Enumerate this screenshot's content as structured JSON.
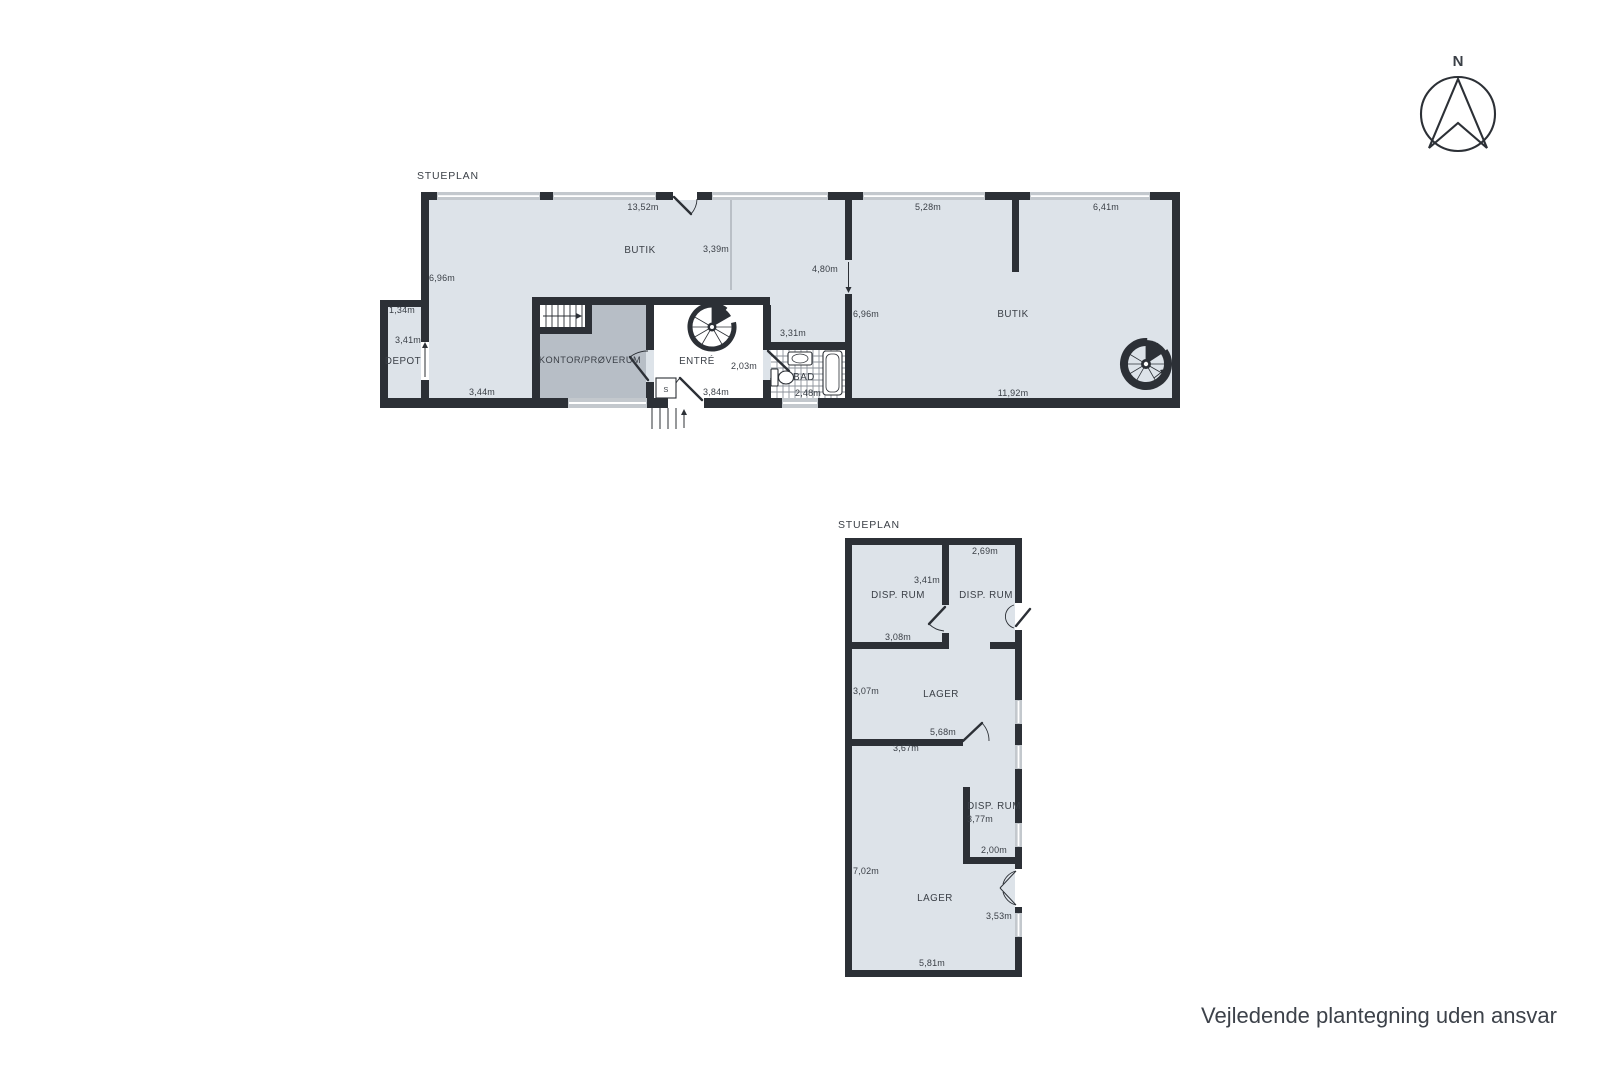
{
  "upper_plan": {
    "title": "STUEPLAN",
    "rooms": {
      "butik_left": "BUTIK",
      "depot": "DEPOT",
      "kontor": "KONTOR/PRØVERUM",
      "entre": "ENTRÉ",
      "bad": "BAD",
      "butik_right": "BUTIK",
      "shaft": "S"
    },
    "dimensions": {
      "top_width": "13,52m",
      "left_height": "6,96m",
      "butik_depth": "3,39m",
      "depot_width": "1,34m",
      "depot_height": "3,41m",
      "bottom_left_width": "3,44m",
      "entre_width": "3,84m",
      "bad_door": "2,03m",
      "bad_top_width": "3,31m",
      "bad_width": "2,48m",
      "opening_width": "4,80m",
      "butik_right_height": "6,96m",
      "top_width_mid": "5,28m",
      "top_width_right": "6,41m",
      "bottom_right_width": "11,92m"
    }
  },
  "lower_plan": {
    "title": "STUEPLAN",
    "rooms": {
      "disp_rum_top_left": "DISP. RUM",
      "disp_rum_top_right": "DISP. RUM",
      "lager_upper": "LAGER",
      "disp_rum_lower": "DISP. RUM",
      "lager_lower": "LAGER"
    },
    "dimensions": {
      "top_right_width": "2,69m",
      "disp_left_height": "3,41m",
      "disp_left_width": "3,08m",
      "lager_upper_height": "3,07m",
      "lager_upper_width": "5,68m",
      "lager_upper_inner_width": "3,67m",
      "disp_lower_height": "3,77m",
      "disp_lower_width": "2,00m",
      "lager_lower_height": "7,02m",
      "lager_lower_right_height": "3,53m",
      "lager_lower_width": "5,81m"
    }
  },
  "compass": {
    "north_label": "N"
  },
  "footer": {
    "disclaimer": "Vejledende plantegning uden ansvar"
  },
  "colors": {
    "wall": "#2c3036",
    "floor": "#dde3e9",
    "room_dark": "#b7bec6",
    "window": "#c3c8cd",
    "text": "#3a3f46"
  }
}
